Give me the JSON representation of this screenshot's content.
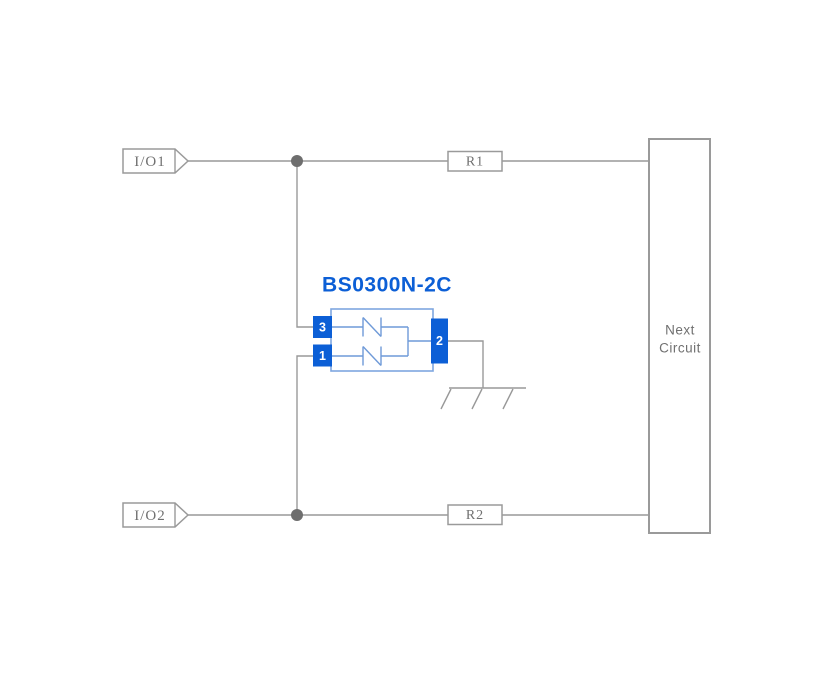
{
  "colors": {
    "accent": "#0C5FD6",
    "body-stroke": "#7EA6E0",
    "inner-stroke": "#6F9AD8",
    "wire-color": "#999999",
    "dot-color": "#6E6E6E",
    "box-stroke": "#9A9A9A",
    "label-color": "#707070"
  },
  "io": {
    "top": "I/O1",
    "bottom": "I/O2"
  },
  "resistors": {
    "top": "R1",
    "bottom": "R2"
  },
  "component": {
    "title": "BS0300N-2C",
    "pin_top_left": "3",
    "pin_bottom_left": "1",
    "pin_right": "2"
  },
  "next_circuit": {
    "line1": "Next",
    "line2": "Circuit"
  }
}
